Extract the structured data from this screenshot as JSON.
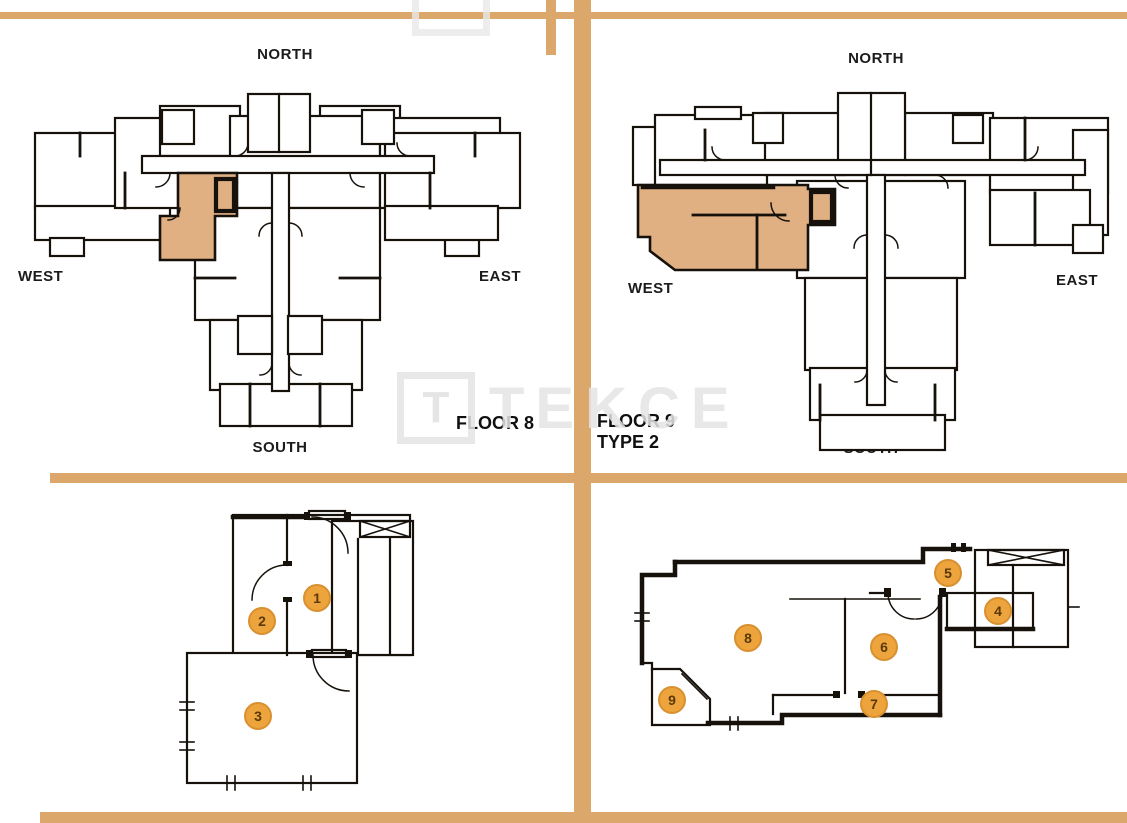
{
  "colors": {
    "divider": "#DCA76A",
    "highlight_unit": "#E0B083",
    "wall": "#17110B",
    "label_text": "#1B1B1B",
    "marker_fill": "#EDA43C",
    "marker_border": "#D89030",
    "marker_number": "#5A3A0A",
    "watermark": "#E4E4E4"
  },
  "watermark": {
    "logo_letter": "T",
    "text": "TEKCE"
  },
  "floor8": {
    "title": "FLOOR 8",
    "compass": {
      "north": "NORTH",
      "west": "WEST",
      "east": "EAST",
      "south": "SOUTH"
    }
  },
  "floor9": {
    "title_line1": "FLOOR 9",
    "title_line2": "TYPE 2",
    "compass": {
      "north": "NORTH",
      "west": "WEST",
      "east": "EAST",
      "south": "SOUTH"
    }
  },
  "unit_left": {
    "rooms": {
      "r1": "1",
      "r2": "2",
      "r3": "3"
    }
  },
  "unit_right": {
    "rooms": {
      "r4": "4",
      "r5": "5",
      "r6": "6",
      "r7": "7",
      "r8": "8",
      "r9": "9"
    }
  }
}
